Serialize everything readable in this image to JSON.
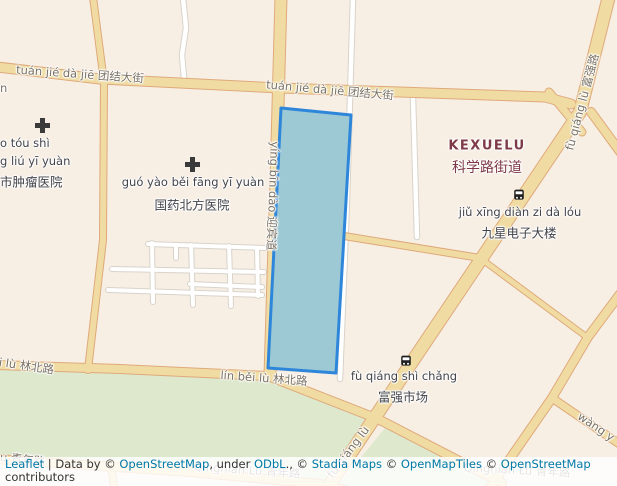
{
  "map": {
    "district": {
      "en": "KEXUELU",
      "zh": "科学路街道"
    },
    "road_labels": {
      "tuanjie1": "tuán jié dà jiē 团结大街",
      "tuanjie2": "tuán jié dà jiē 团结大街",
      "yingbindao": "yíng bīn dào 迎宾道",
      "linbei_left": "i lù 林北路",
      "linbei_right": "lín běi lù 林北路",
      "qingnian_left": "u 青年路",
      "qingnian_mid": "Qingnian Lu 青年路",
      "qingnian_right": "Qingnian Lu 青年路",
      "fuqiang_top": "fù qiáng lù 富强路",
      "fuqiang_bottom": "fù qiáng lù",
      "wang_partial": "wàng y",
      "edge_partial": "n"
    },
    "pois": {
      "hospital_left": {
        "icon": "hospital-cross",
        "line1": "o tóu shì",
        "line2": "g liú yī yuàn",
        "line3": "市肿瘤医院"
      },
      "hospital_main": {
        "icon": "hospital-cross",
        "en": "guó yào běi fāng yī yuàn",
        "zh": "国药北方医院"
      },
      "jiuxing": {
        "icon": "bus-stop",
        "en": "jiǔ xīng diàn zi dà lóu",
        "zh": "九星电子大楼"
      },
      "market": {
        "icon": "bus-stop",
        "en": "fù qiáng shì chǎng",
        "zh": "富强市场"
      }
    },
    "selection": {
      "fill": "#9cc9d4",
      "stroke": "#2e86db"
    },
    "colors": {
      "land": "#f8efe4",
      "park": "#dde8cc",
      "road_fill": "#f0dca2",
      "road_casing": "#dfa97b",
      "white_road": "#ffffff",
      "white_road_casing": "#d8d3ca",
      "road_label": "#7b7265",
      "poi_label": "#43444a",
      "district_label": "#7e3a46",
      "link": "#0078a8"
    },
    "attribution": {
      "parts": [
        {
          "t": "Leaflet"
        },
        {
          "t": " | Data by © "
        },
        {
          "t": "OpenStreetMap"
        },
        {
          "t": ", under "
        },
        {
          "t": "ODbL"
        },
        {
          "t": "., © "
        },
        {
          "t": "Stadia Maps"
        },
        {
          "t": " © "
        },
        {
          "t": "OpenMapTiles"
        },
        {
          "t": " © "
        },
        {
          "t": "OpenStreetMap"
        },
        {
          "t": " contributors"
        }
      ]
    }
  }
}
